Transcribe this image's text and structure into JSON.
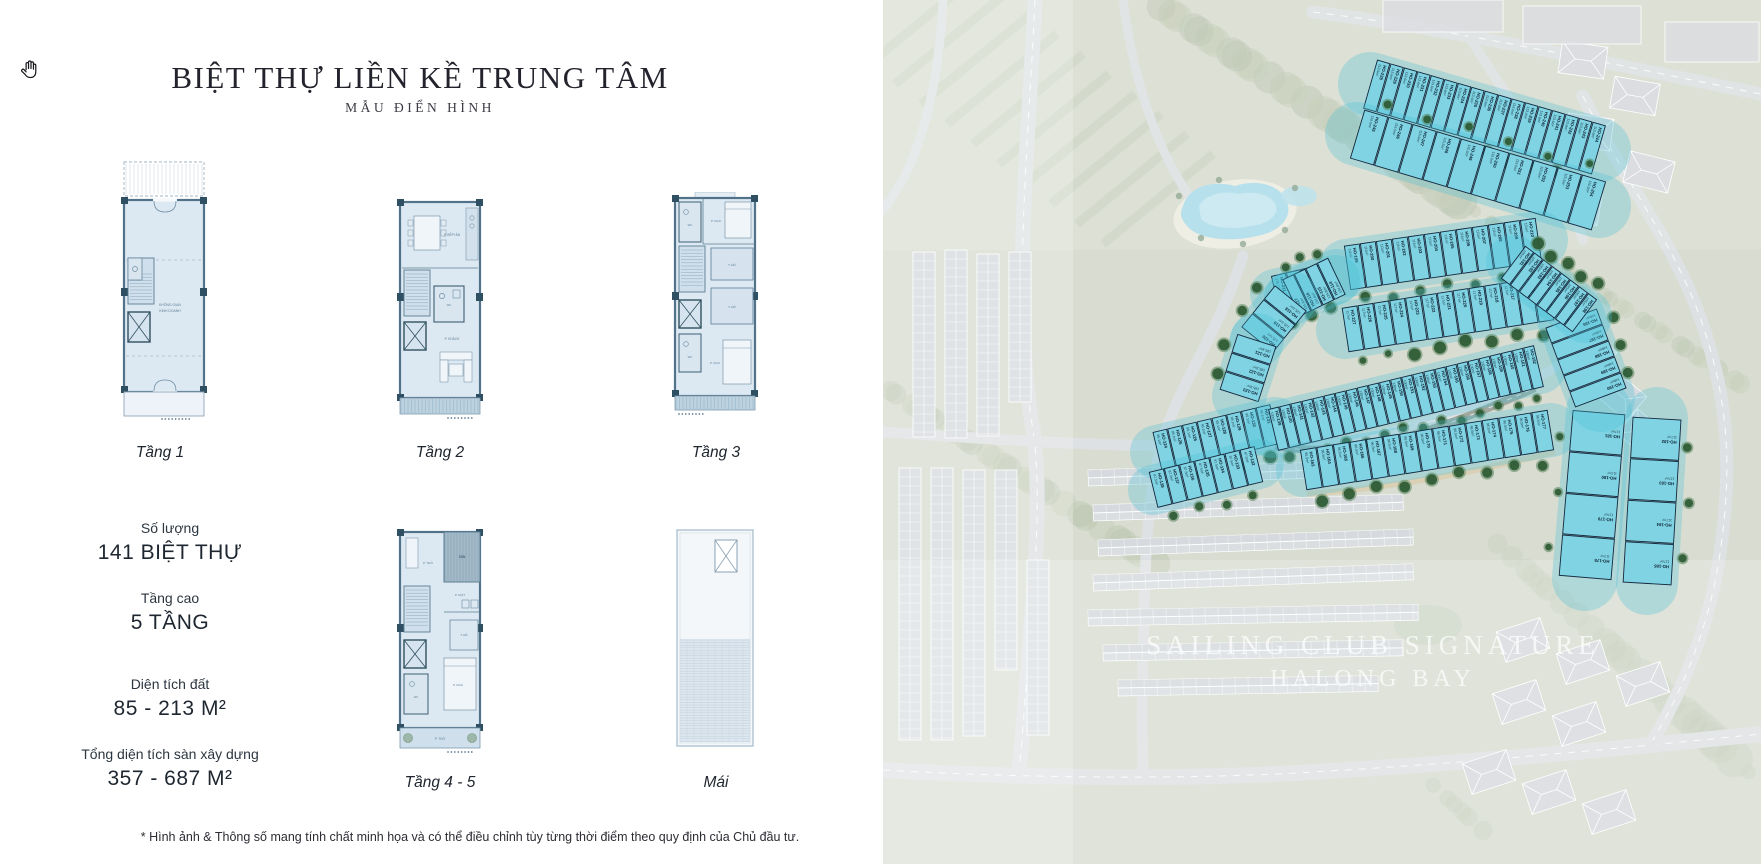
{
  "left_panel": {
    "title": "BIỆT THỰ LIỀN KỀ TRUNG TÂM",
    "subtitle": "MẪU ĐIỂN HÌNH",
    "plans": [
      {
        "label": "Tầng 1",
        "rooms": {
          "main1": "KHÔNG GIAN",
          "main2": "KINH DOANH"
        }
      },
      {
        "label": "Tầng 2",
        "rooms": {
          "kitchen": "P. BẾP+ĂN",
          "wc": "WC",
          "living": "P. KHÁCH"
        }
      },
      {
        "label": "Tầng 3",
        "rooms": {
          "wc1": "WC",
          "bed1": "P. NGỦ",
          "ward1": "T. ĐỒ",
          "ward2": "T. ĐỒ",
          "wc2": "WC",
          "bed2": "P. NGỦ"
        }
      },
      {
        "label": "Tầng 4 - 5",
        "rooms": {
          "altar": "P. THỜ",
          "terrace": "SÂN",
          "laundry": "P. GIẶT",
          "ward": "T. ĐỒ",
          "wc": "WC",
          "bed": "P. NGỦ",
          "yard": "P. THỜ"
        }
      },
      {
        "label": "Mái",
        "rooms": {}
      }
    ],
    "stats": [
      {
        "label": "Số lượng",
        "value": "141 BIỆT THỰ"
      },
      {
        "label": "Tầng cao",
        "value": "5 TẦNG"
      },
      {
        "label": "Diện tích đất",
        "value": "85 - 213 M²"
      },
      {
        "label": "Tổng diện tích sàn xây dựng",
        "value": "357 - 687 M²"
      }
    ],
    "footnote": "* Hình ảnh & Thông số mang tính chất minh họa và có thể điều chỉnh tùy từng thời điểm theo quy định của Chủ đầu tư."
  },
  "map": {
    "watermark_line1": "SAILING CLUB SIGNATURE",
    "watermark_line2": "HALONG BAY",
    "lot_prefix": "HO-",
    "colors": {
      "lot_fill": "#7fd3e2",
      "lot_border": "#14283e",
      "glow": "#49c0d6",
      "tree": "#2d5a34",
      "tree_halo": "#4f7d54",
      "water": "#8ccfe0",
      "greenery": "#c9cfbd",
      "road": "#d0d4d7"
    },
    "areas_observed": [
      "113.6m²",
      "115.5m²",
      "135.7m²",
      "134.8m²",
      "125.1m²",
      "185.3m²",
      "176.5m²",
      "105.4m²",
      "95.4m²",
      "94.8m²",
      "95.1m²",
      "130m²",
      "140.6m²",
      "96.5m²",
      "117m²",
      "193.1m²",
      "193.6m²",
      "197.1m²",
      "148m²",
      "145.1m²",
      "145.4m²",
      "193m²",
      "205.1m²"
    ],
    "clusters": [
      {
        "name": "top-right-row-1",
        "id_start": 228,
        "count": 17,
        "x1": 487,
        "y1": 84,
        "x2": 716,
        "y2": 150,
        "depth": 50,
        "area": "113.6m²",
        "tree_side": 1,
        "reverse": false
      },
      {
        "name": "top-right-row-2",
        "id_start": 245,
        "count": 10,
        "x1": 474,
        "y1": 134,
        "x2": 716,
        "y2": 206,
        "depth": 50,
        "area": "115.5m²",
        "tree_side": -1,
        "reverse": false
      },
      {
        "name": "upper-mid-row",
        "id_start": 199,
        "count": 12,
        "x1": 464,
        "y1": 268,
        "x2": 656,
        "y2": 240,
        "depth": 44,
        "area": "111m²",
        "tree_side": 1,
        "reverse": false
      },
      {
        "name": "pool-side-row",
        "id_start": 211,
        "count": 4,
        "x1": 392,
        "y1": 294,
        "x2": 452,
        "y2": 280,
        "depth": 36,
        "area": "135.7m²",
        "tree_side": 1,
        "reverse": false
      },
      {
        "name": "mid-row",
        "id_start": 215,
        "count": 13,
        "x1": 462,
        "y1": 330,
        "x2": 668,
        "y2": 298,
        "depth": 44,
        "area": "117m²",
        "tree_side": 1,
        "reverse": true
      },
      {
        "name": "curve-row-a",
        "id_start": 114,
        "count": 4,
        "x1": 454,
        "y1": 276,
        "x2": 408,
        "y2": 298,
        "depth": 40,
        "area": "134.8m²",
        "tree_side": 1,
        "reverse": false
      },
      {
        "name": "curve-row-b",
        "id_start": 118,
        "count": 3,
        "x1": 408,
        "y1": 298,
        "x2": 374,
        "y2": 340,
        "depth": 40,
        "area": "125.1m²",
        "tree_side": 1,
        "reverse": false
      },
      {
        "name": "curve-row-c",
        "id_start": 121,
        "count": 3,
        "x1": 374,
        "y1": 340,
        "x2": 356,
        "y2": 396,
        "depth": 40,
        "area": "185.3m²",
        "tree_side": 1,
        "reverse": false
      },
      {
        "name": "lower-left-row-1",
        "id_start": 124,
        "count": 8,
        "x1": 274,
        "y1": 452,
        "x2": 392,
        "y2": 424,
        "depth": 40,
        "area": "95.1m²",
        "tree_side": 1,
        "reverse": false
      },
      {
        "name": "lower-left-row-2",
        "id_start": 132,
        "count": 7,
        "x1": 270,
        "y1": 490,
        "x2": 376,
        "y2": 464,
        "depth": 36,
        "area": "87.5m²",
        "tree_side": 1,
        "reverse": true
      },
      {
        "name": "long-row",
        "id_start": 139,
        "count": 24,
        "x1": 390,
        "y1": 430,
        "x2": 656,
        "y2": 366,
        "depth": 42,
        "area": "130m²",
        "tree_side": 1,
        "reverse": false
      },
      {
        "name": "south-row",
        "id_start": 163,
        "count": 15,
        "x1": 420,
        "y1": 470,
        "x2": 668,
        "y2": 430,
        "depth": 40,
        "area": "96.5m²",
        "tree_side": 1,
        "reverse": false
      },
      {
        "name": "east-col-1",
        "id_start": 178,
        "count": 4,
        "x1": 716,
        "y1": 412,
        "x2": 702,
        "y2": 578,
        "depth": 52,
        "area": "117m²",
        "tree_side": 1,
        "reverse": true
      },
      {
        "name": "east-col-2",
        "id_start": 182,
        "count": 4,
        "x1": 774,
        "y1": 418,
        "x2": 764,
        "y2": 584,
        "depth": 48,
        "area": "117m²",
        "tree_side": -1,
        "reverse": false
      },
      {
        "name": "east-fan",
        "id_start": 186,
        "count": 5,
        "x1": 688,
        "y1": 318,
        "x2": 718,
        "y2": 398,
        "depth": 54,
        "area": "148m²",
        "tree_side": -1,
        "reverse": false
      },
      {
        "name": "east-upper",
        "id_start": 191,
        "count": 8,
        "x1": 630,
        "y1": 262,
        "x2": 702,
        "y2": 316,
        "depth": 40,
        "area": "105m²",
        "tree_side": -1,
        "reverse": false
      }
    ]
  }
}
